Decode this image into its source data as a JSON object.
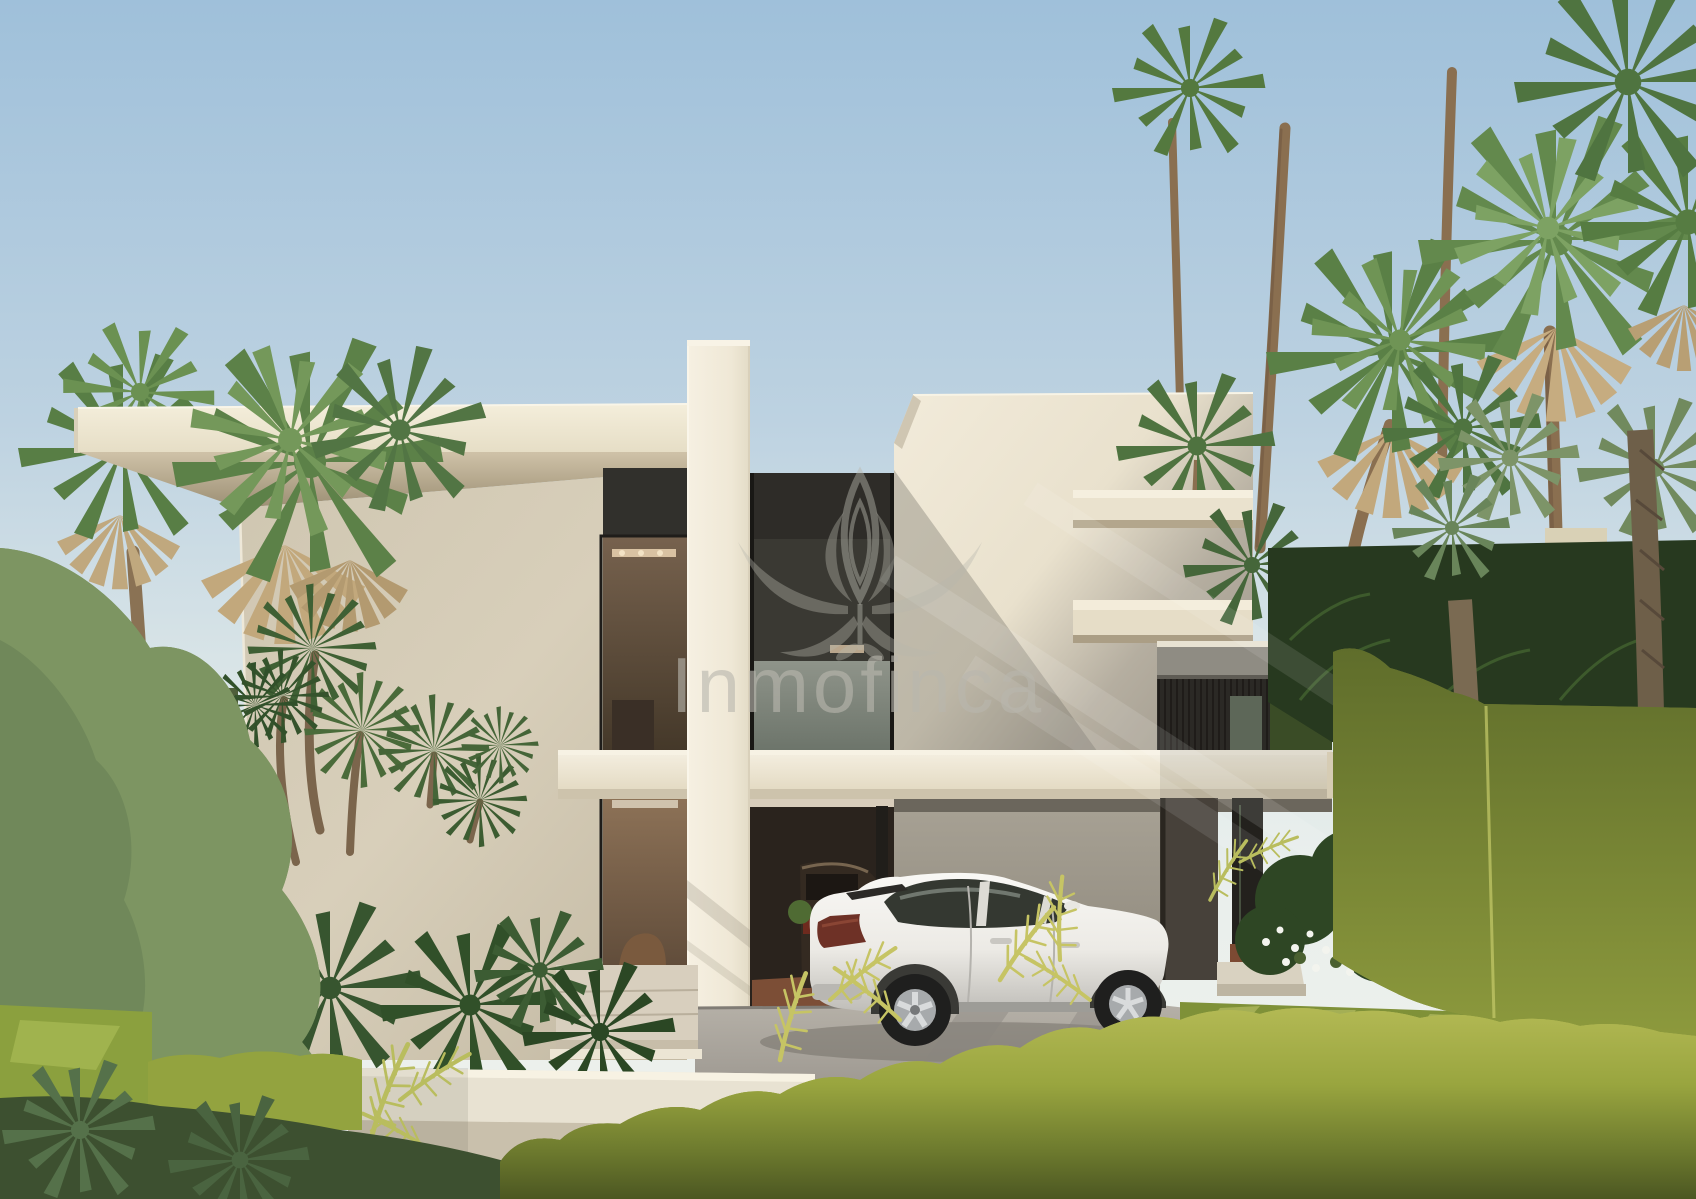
{
  "watermark": {
    "brand": "Inmofinca",
    "logo": "lotus-flower-icon"
  },
  "scene": {
    "subject": "modern two-storey white villa with cantilevered flat roofs and carport",
    "vehicles": [
      "white suv coupe parked under carport",
      "dark suv inside garage"
    ],
    "vegetation": [
      "fan palms",
      "dracaena",
      "trimmed hedges",
      "leafy tree",
      "white flowers"
    ],
    "sky": "clear gradient sky"
  },
  "palette": {
    "sky_top": "#a2c2dc",
    "sky_horizon": "#e9efec",
    "facade_cream": "#f0e9d8",
    "facade_shadow": "#cdc4ae",
    "soffit_tan": "#a3967c",
    "window_frame_dark": "#2e2c28",
    "glass_reflection": "#8d9286",
    "interior_warm": "#7b6450",
    "beam_white": "#f0e9d9",
    "concrete_gray": "#9d978b",
    "driveway_gray": "#b2ada4",
    "car_white": "#f2f1ed",
    "suv_dark": "#342a21",
    "hedge_bright": "#a9b149",
    "hedge_olive": "#76842f",
    "foliage_dark": "#2f4a28",
    "palm_green": "#5a8046",
    "palm_skirt": "#c2a87c",
    "trunk_brown": "#8a6f50",
    "lawn_green": "#8ba03e",
    "flower_white": "#f3f4ee",
    "watermark_gray": "#b9b7ae"
  }
}
